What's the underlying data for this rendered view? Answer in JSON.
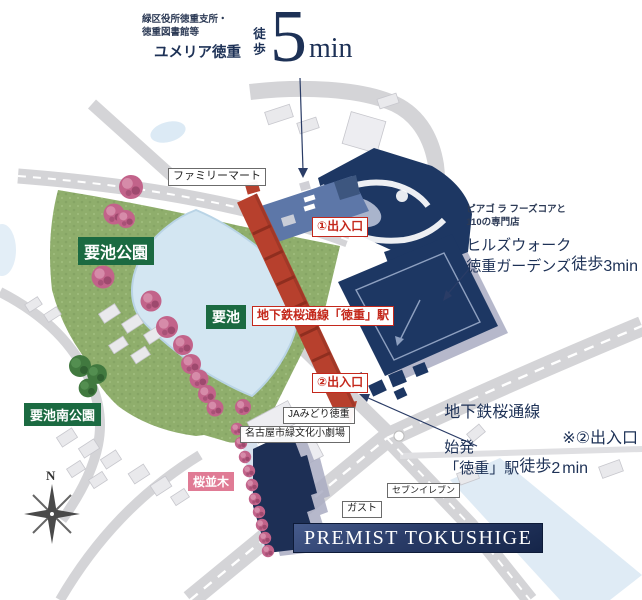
{
  "colors": {
    "navy": "#1d3156",
    "red": "#c4281c",
    "station_red": "#b7402d",
    "stripe_red": "#8f2e1f",
    "green_label": "#1b6a41",
    "pink_label": "#e07b95",
    "park_green": "#8fae6c",
    "pond_blue": "#d3e6f2",
    "road_gray": "#d4d4d7",
    "building_blue": "#5d77a8",
    "building_navy": "#1d3763",
    "premist_navy": "#1d2f55",
    "shadow_lavender": "#a9abc2"
  },
  "annotations": {
    "yumeria": {
      "sub1": "緑区役所徳重支所・",
      "sub2": "徳重図書館等",
      "name": "ユメリア徳重",
      "walk": "徒歩",
      "minutes": "5",
      "unit": "min"
    },
    "hillswalk": {
      "sub1": "ピアゴ ラ フーズコアと",
      "sub2": "110の専門店",
      "name1": "ヒルズウォーク",
      "name2": "徳重ガーデンズ",
      "walk": "徒歩",
      "minutes": "3",
      "unit": "min"
    },
    "station2min": {
      "sub": "地下鉄桜通線",
      "name1": "始発",
      "name2": "「徳重」駅",
      "walk": "徒歩",
      "minutes": "2",
      "unit": "min",
      "note": "※②出入口"
    }
  },
  "labels": {
    "family_mart": "ファミリーマート",
    "exit1": "①出入口",
    "exit2": "②出入口",
    "station": "地下鉄桜通線「徳重」駅",
    "kaname_pond": "要池",
    "kaname_park": "要池公園",
    "kaname_south_park": "要池南公園",
    "ja_midori": "JAみどり徳重",
    "theater": "名古屋市緑文化小劇場",
    "sakura_row": "桜並木",
    "gusto": "ガスト",
    "seven_eleven": "セブンイレブン",
    "premist": "PREMIST TOKUSHIGE",
    "compass_north": "N"
  }
}
